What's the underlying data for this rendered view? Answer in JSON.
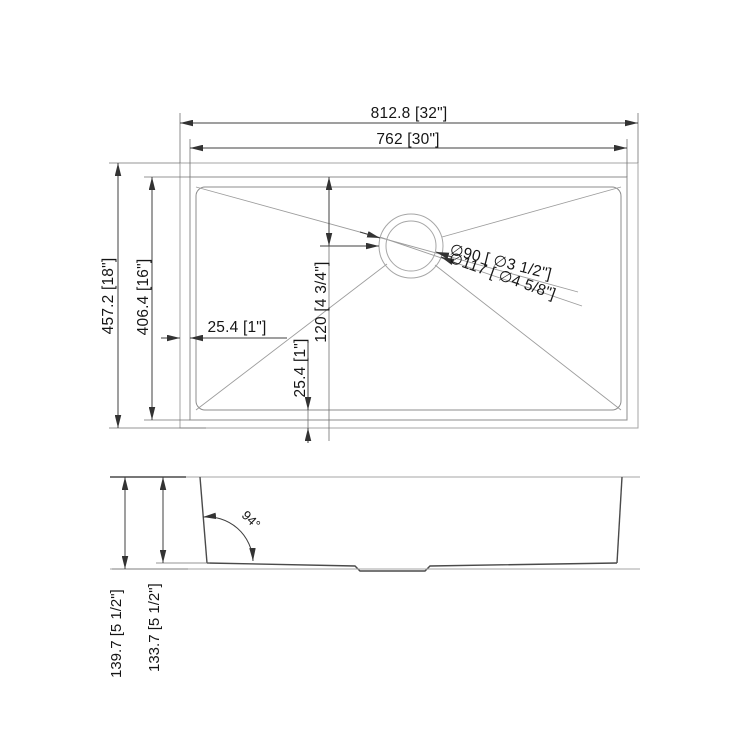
{
  "drawing": {
    "type": "sink technical dimension drawing",
    "views": [
      "top view",
      "side view"
    ]
  },
  "top": {
    "overall_width": "812.8 [32\"]",
    "inner_width": "762 [30\"]",
    "overall_depth": "457.2 [18\"]",
    "inner_depth": "406.4 [16\"]",
    "rim_left": "25.4 [1\"]",
    "rim_bottom": "25.4 [1\"]",
    "drain_offset": "120 [4 3/4\"]",
    "drain_diameter_inner": "∅90 [ ∅3 1/2\"]",
    "drain_diameter_outer": "∅117 [ ∅4 5/8\"]"
  },
  "side": {
    "wall_angle": "94°",
    "overall_height": "139.7 [5 1/2\"]",
    "inner_height": "133.7 [5 1/2\"]"
  },
  "colors": {
    "background": "#ffffff",
    "line_dark": "#4a4a4a",
    "line_gray": "#a6a6a6",
    "dimension": "#3f3f3f",
    "text": "#151515"
  }
}
